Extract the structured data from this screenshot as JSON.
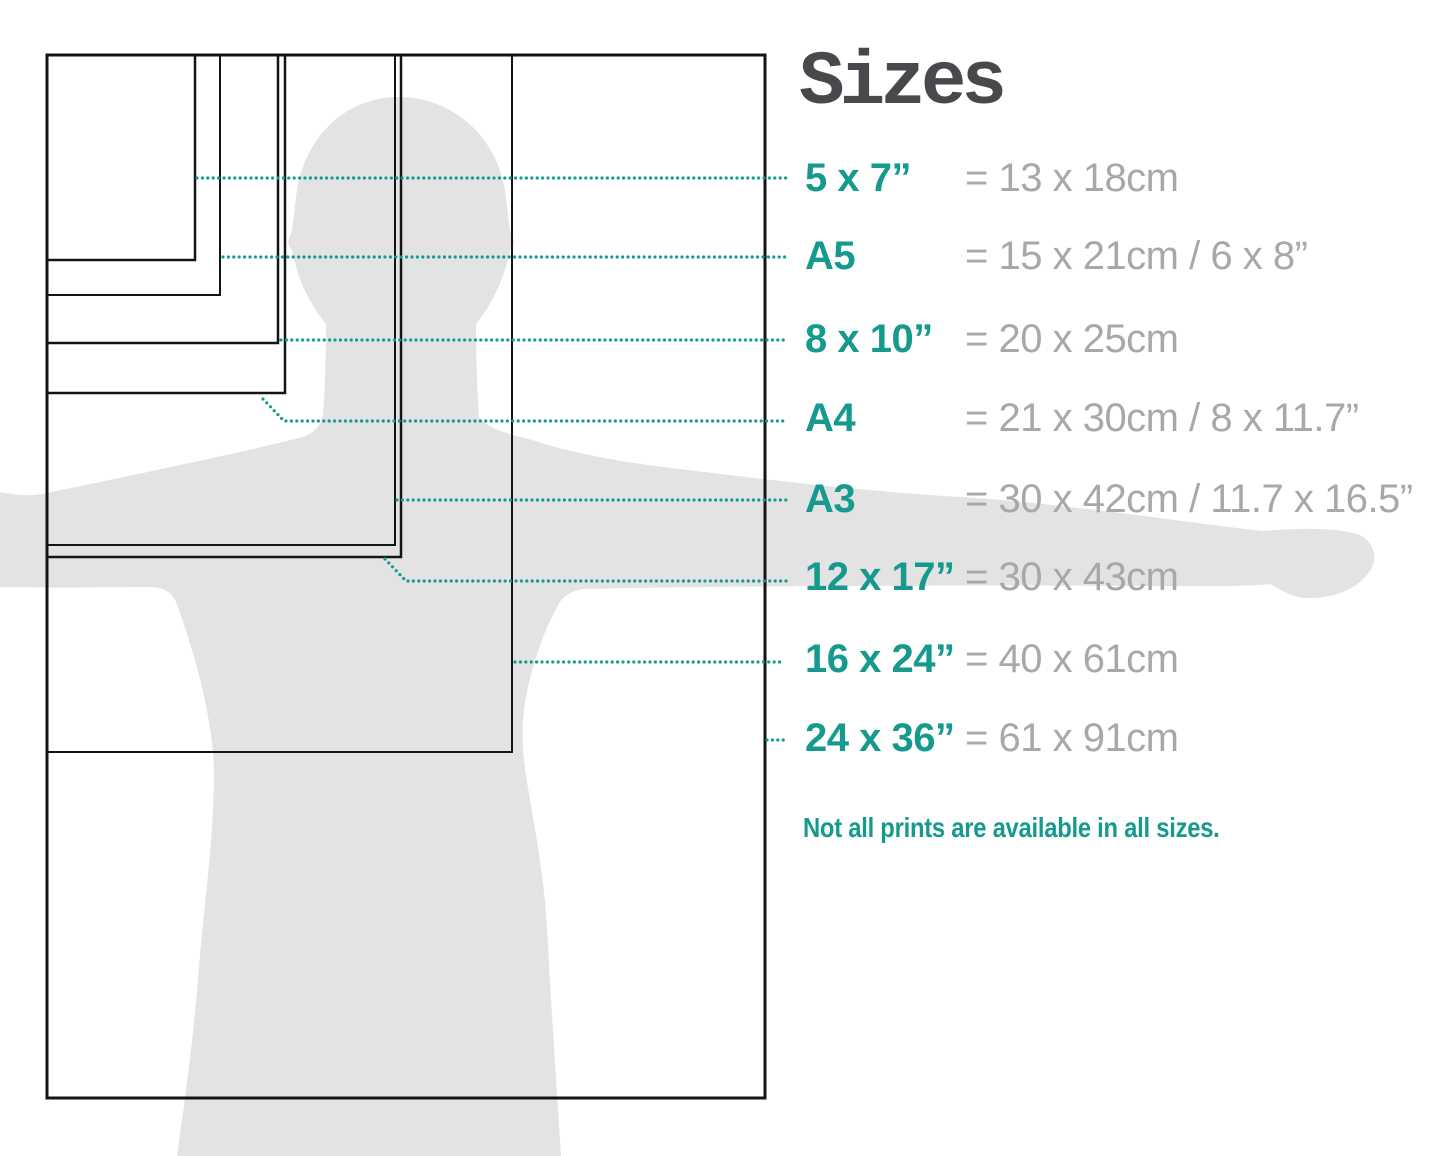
{
  "title": "Sizes",
  "note": "Not all prints are available in all sizes.",
  "sizes": [
    {
      "label": "5 x 7”",
      "metric": "= 13 x 18cm"
    },
    {
      "label": "A5",
      "metric": "= 15 x 21cm / 6 x 8”"
    },
    {
      "label": "8 x 10”",
      "metric": "= 20 x 25cm"
    },
    {
      "label": "A4",
      "metric": "= 21 x 30cm / 8 x 11.7”"
    },
    {
      "label": "A3",
      "metric": "= 30 x 42cm / 11.7 x 16.5”"
    },
    {
      "label": "12 x 17”",
      "metric": "= 30 x 43cm"
    },
    {
      "label": "16 x 24”",
      "metric": "= 40 x 61cm"
    },
    {
      "label": "24 x 36”",
      "metric": "= 61 x 91cm"
    }
  ],
  "colors": {
    "accent_teal": "#169a8e",
    "metric_gray": "#a8a8a8",
    "title_gray": "#47494c",
    "silhouette_gray": "#e3e3e3",
    "line_black": "#141414"
  }
}
